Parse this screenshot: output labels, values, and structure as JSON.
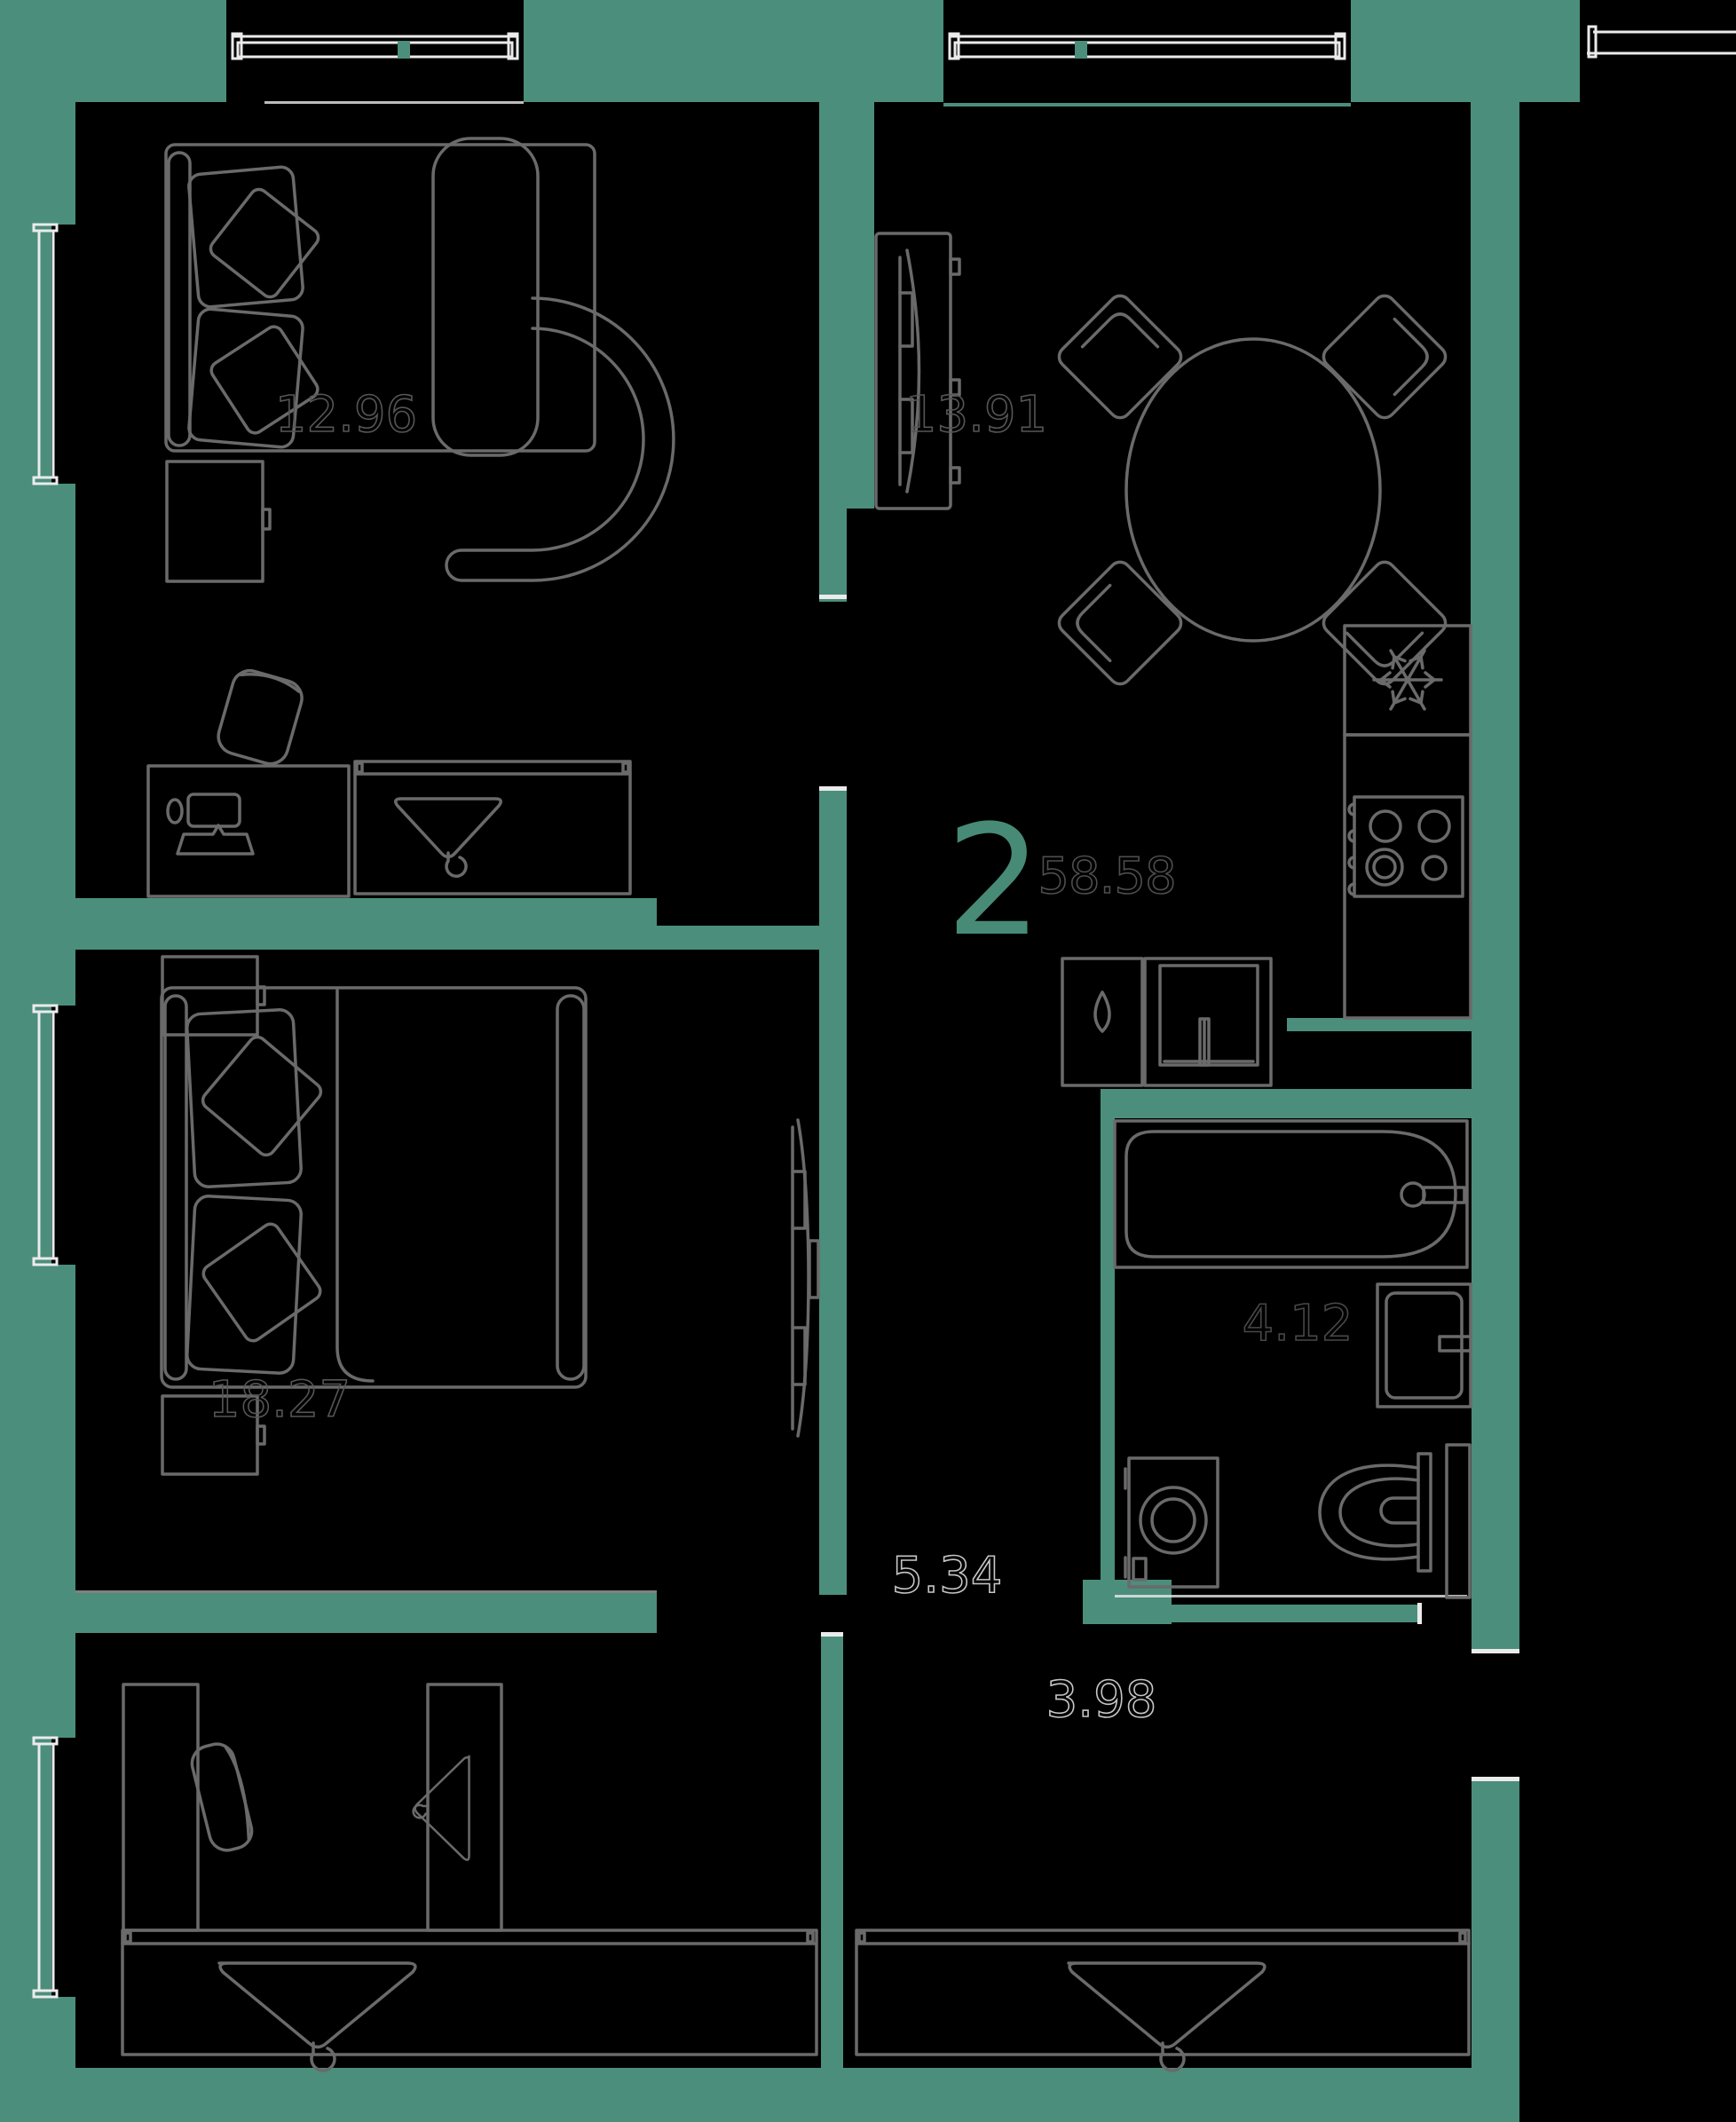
{
  "plan": {
    "apartment_type": "2",
    "total_area": "58.58",
    "rooms": [
      {
        "name": "bedroom-top",
        "area": "12.96"
      },
      {
        "name": "kitchen-living",
        "area": "13.91"
      },
      {
        "name": "bedroom-main",
        "area": "18.27"
      },
      {
        "name": "bathroom",
        "area": "4.12"
      },
      {
        "name": "hallway",
        "area": "5.34"
      },
      {
        "name": "storage",
        "area": "3.98"
      }
    ],
    "icons": {
      "fridge": "snowflake-icon",
      "wardrobes": "hanger-icon",
      "kitchen_sink_unit": "drop-icon"
    },
    "colors": {
      "wall_teal": "#4B8E7C",
      "floor_black": "#000000",
      "furniture_line": "#6a6a6a",
      "window_line": "#ebebeb",
      "room_label": "#565656",
      "corridor_label": "#c6c6c6",
      "accent_teal": "#478B77"
    }
  }
}
